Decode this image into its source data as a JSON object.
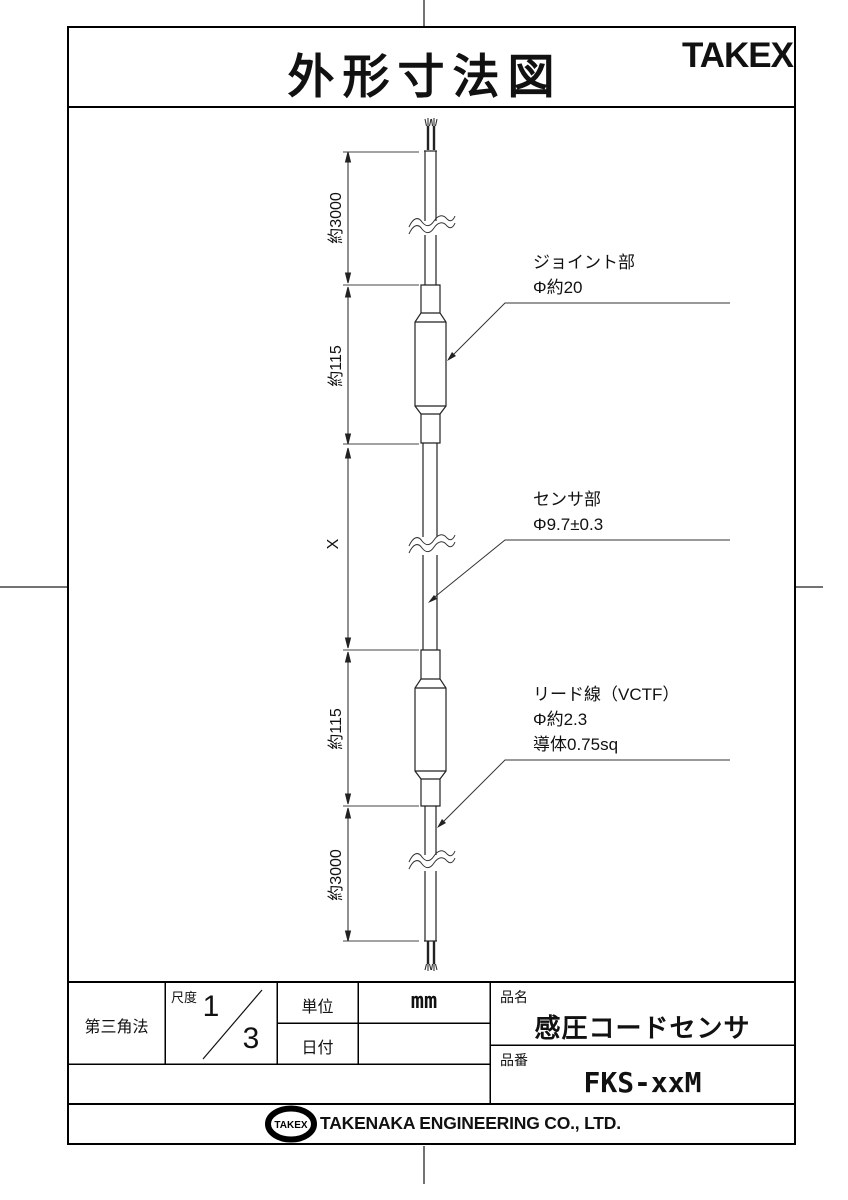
{
  "header": {
    "title": "外形寸法図",
    "brand": "TAKEX"
  },
  "drawing": {
    "dimensions": [
      "約3000",
      "約115",
      "X",
      "約115",
      "約3000"
    ],
    "annotations": [
      {
        "line1": "ジョイント部",
        "line2": "Φ約20"
      },
      {
        "line1": "センサ部",
        "line2": "Φ9.7±0.3"
      },
      {
        "line1": "リード線（VCTF）",
        "line2": "Φ約2.3",
        "line3": "導体0.75sq"
      }
    ]
  },
  "title_block": {
    "projection": "第三角法",
    "scale_label": "尺度",
    "scale_numerator": "1",
    "scale_denominator": "3",
    "unit_label": "単位",
    "unit_value": "mm",
    "date_label": "日付",
    "date_value": "",
    "name_label": "品名",
    "name_value": "感圧コードセンサ",
    "number_label": "品番",
    "number_value": "FKS-xxM"
  },
  "footer": {
    "logo": "TAKEX",
    "company": "TAKENAKA ENGINEERING CO., LTD."
  },
  "colors": {
    "line": "#1a1a1a",
    "border": "#000000",
    "background": "#ffffff"
  }
}
